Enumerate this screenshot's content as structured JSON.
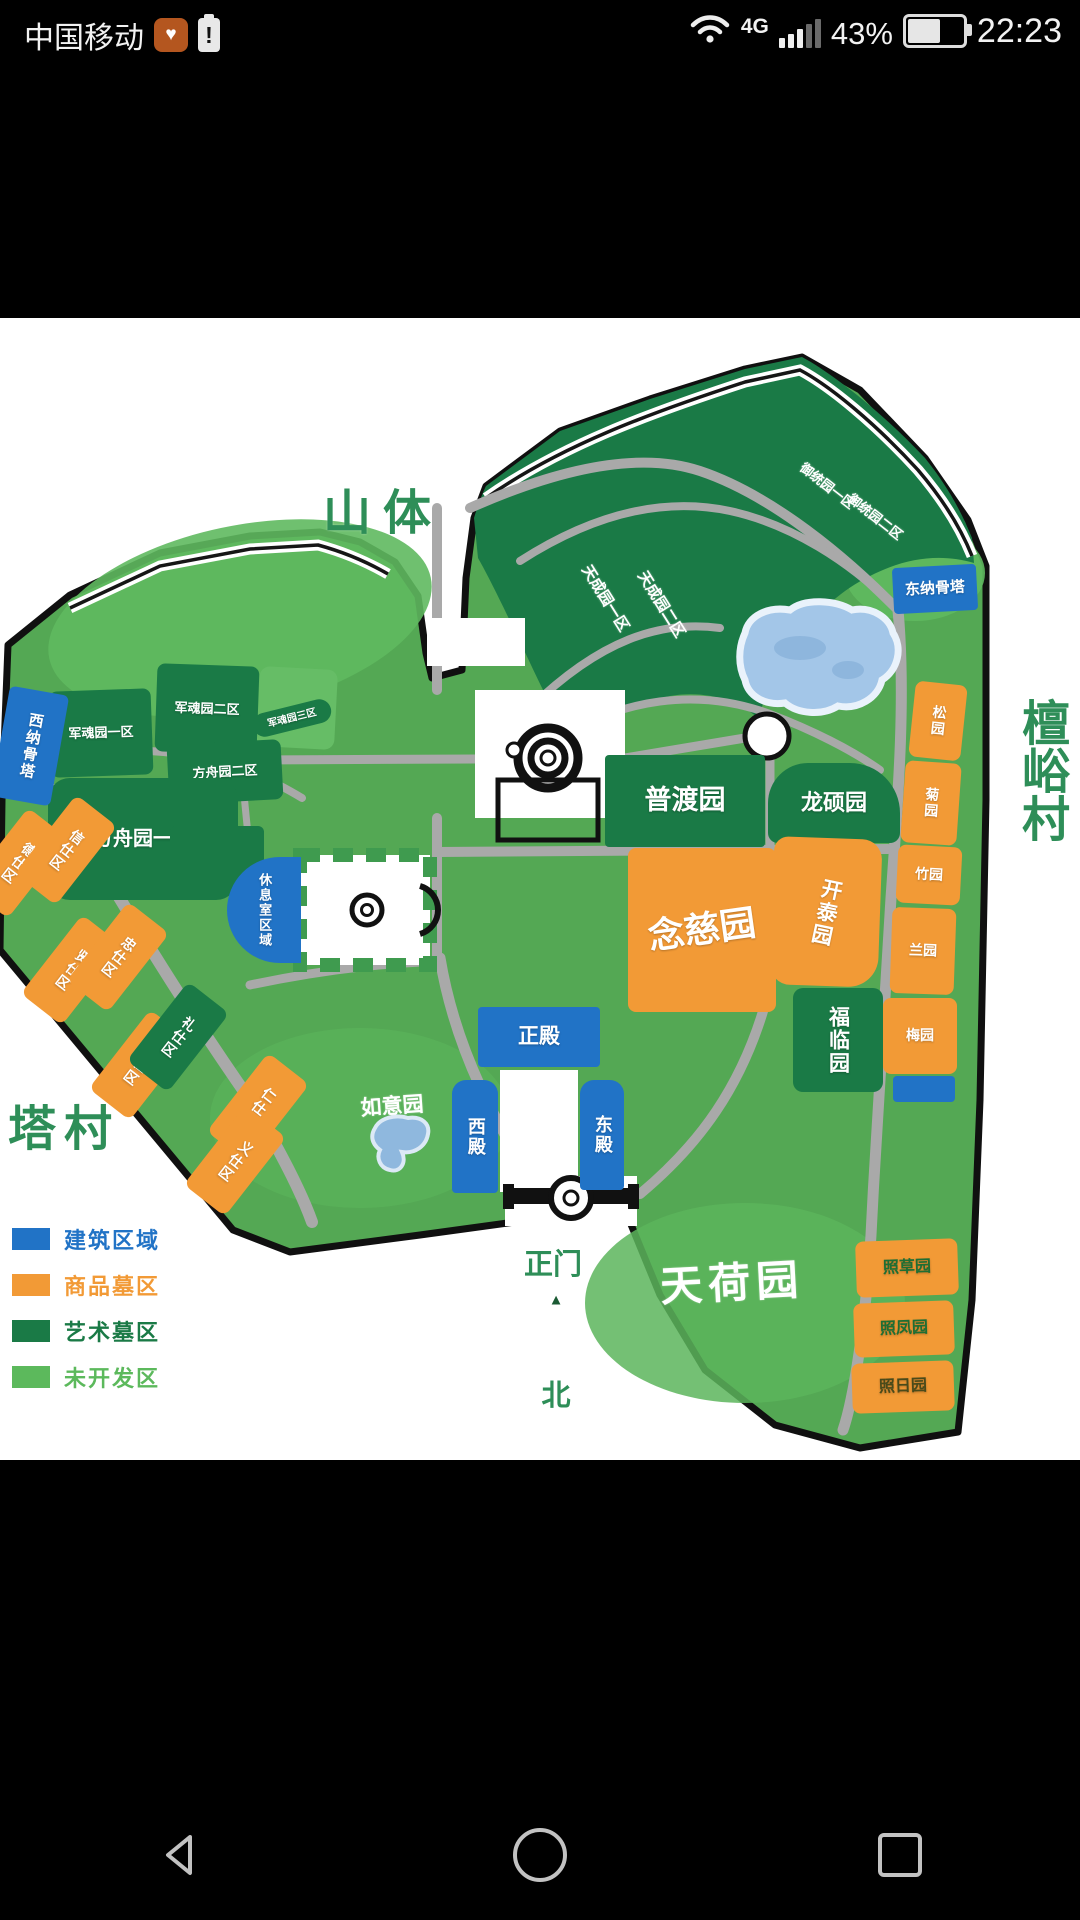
{
  "status_bar": {
    "carrier": "中国移动",
    "health_icon_char": "♥",
    "battery_alert_char": "!",
    "network_type": "4G",
    "battery_percent": "43%",
    "time": "22:23"
  },
  "map": {
    "regions": [
      {
        "id": "junhun3-bg",
        "label": "",
        "cls": "undev2",
        "x": 258,
        "y": 350,
        "w": 78,
        "h": 80,
        "rot": 3,
        "r": 10
      },
      {
        "id": "junhun2",
        "label": "军魂园二区",
        "cls": "art",
        "x": 156,
        "y": 347,
        "w": 102,
        "h": 88,
        "rot": 2,
        "fs": 13,
        "r": 8
      },
      {
        "id": "junhun1",
        "label": "军魂园一区",
        "cls": "art",
        "x": 50,
        "y": 372,
        "w": 102,
        "h": 86,
        "rot": -2,
        "fs": 13,
        "r": 8
      },
      {
        "id": "junhun3",
        "label": "军魂园三区",
        "cls": "art",
        "x": 252,
        "y": 388,
        "w": 80,
        "h": 24,
        "rot": -14,
        "fs": 10,
        "r": 14
      },
      {
        "id": "fangzhou2",
        "label": "方舟园二区",
        "cls": "art",
        "x": 168,
        "y": 424,
        "w": 114,
        "h": 60,
        "rot": -3,
        "fs": 13,
        "r": 8
      },
      {
        "id": "fangzhou1",
        "label": "方舟园一区",
        "cls": "art",
        "x": 48,
        "y": 460,
        "w": 190,
        "h": 122,
        "rot": 0,
        "fs": 20,
        "r": 22
      },
      {
        "id": "xiuxi-bg",
        "label": "",
        "cls": "art",
        "x": 170,
        "y": 508,
        "w": 94,
        "h": 62,
        "rot": 0,
        "r": 6
      },
      {
        "id": "pudu",
        "label": "普渡园",
        "cls": "art",
        "x": 605,
        "y": 437,
        "w": 160,
        "h": 92,
        "rot": 0,
        "fs": 27,
        "r": 4
      },
      {
        "id": "longshuo",
        "label": "龙硕园",
        "cls": "art",
        "x": 768,
        "y": 445,
        "w": 132,
        "h": 80,
        "rot": 0,
        "fs": 22,
        "r": "40px 50px 10px 10px"
      },
      {
        "id": "nianci",
        "label": "念慈园",
        "cls": "com",
        "x": 628,
        "y": 530,
        "w": 148,
        "h": 164,
        "rot": 0,
        "fs": 36,
        "r": 8,
        "lrot": -8
      },
      {
        "id": "kaitai",
        "label": "开泰园",
        "cls": "com",
        "x": 772,
        "y": 520,
        "w": 108,
        "h": 148,
        "rot": 2,
        "fs": 21,
        "vert": 1,
        "r": "14px 20px 30px 20px",
        "lrot": 10
      },
      {
        "id": "fulin",
        "label": "福临园",
        "cls": "art",
        "x": 793,
        "y": 670,
        "w": 90,
        "h": 104,
        "rot": 0,
        "fs": 21,
        "vert": 1,
        "r": 10
      },
      {
        "id": "shi-de",
        "label": "德仕区",
        "cls": "com",
        "x": -8,
        "y": 495,
        "w": 52,
        "h": 100,
        "rot": 38,
        "fs": 14,
        "vert": 1,
        "r": 8
      },
      {
        "id": "shi-xin",
        "label": "信仕区",
        "cls": "com",
        "x": 40,
        "y": 482,
        "w": 52,
        "h": 100,
        "rot": 38,
        "fs": 14,
        "vert": 1,
        "r": 8
      },
      {
        "id": "shi-xian",
        "label": "贤仕区",
        "cls": "com",
        "x": 46,
        "y": 602,
        "w": 52,
        "h": 100,
        "rot": 38,
        "fs": 14,
        "vert": 1,
        "r": 8
      },
      {
        "id": "shi-zhong",
        "label": "忠仕区",
        "cls": "com",
        "x": 92,
        "y": 589,
        "w": 52,
        "h": 100,
        "rot": 38,
        "fs": 14,
        "vert": 1,
        "r": 8
      },
      {
        "id": "shi-zhi",
        "label": "智仕区",
        "cls": "com",
        "x": 114,
        "y": 697,
        "w": 52,
        "h": 100,
        "rot": 38,
        "fs": 14,
        "vert": 1,
        "r": 8
      },
      {
        "id": "shi-li",
        "label": "礼仕区",
        "cls": "art",
        "x": 152,
        "y": 669,
        "w": 52,
        "h": 100,
        "rot": 38,
        "fs": 14,
        "vert": 1,
        "r": 8
      },
      {
        "id": "shi-ren",
        "label": "仁仕区",
        "cls": "com",
        "x": 232,
        "y": 740,
        "w": 52,
        "h": 100,
        "rot": 38,
        "fs": 14,
        "vert": 1,
        "r": 8
      },
      {
        "id": "shi-yi",
        "label": "义仕区",
        "cls": "com",
        "x": 209,
        "y": 793,
        "w": 52,
        "h": 100,
        "rot": 38,
        "fs": 14,
        "vert": 1,
        "r": 8
      },
      {
        "id": "song",
        "label": "松园",
        "cls": "com",
        "x": 912,
        "y": 365,
        "w": 52,
        "h": 76,
        "rot": 6,
        "fs": 14,
        "vert": 1,
        "r": 8
      },
      {
        "id": "ju",
        "label": "菊园",
        "cls": "com",
        "x": 903,
        "y": 444,
        "w": 56,
        "h": 82,
        "rot": 4,
        "fs": 14,
        "vert": 1,
        "r": 8
      },
      {
        "id": "zhu",
        "label": "竹园",
        "cls": "com",
        "x": 897,
        "y": 528,
        "w": 64,
        "h": 58,
        "rot": 3,
        "fs": 14,
        "r": 8
      },
      {
        "id": "lan",
        "label": "兰园",
        "cls": "com",
        "x": 891,
        "y": 590,
        "w": 64,
        "h": 86,
        "rot": 2,
        "fs": 14,
        "r": 8
      },
      {
        "id": "mei",
        "label": "梅园",
        "cls": "com",
        "x": 883,
        "y": 680,
        "w": 74,
        "h": 76,
        "rot": 0,
        "fs": 14,
        "r": 8
      },
      {
        "id": "blue-annex",
        "label": "",
        "cls": "bld",
        "x": 893,
        "y": 758,
        "w": 62,
        "h": 26,
        "rot": 0,
        "r": 4
      },
      {
        "id": "zhaocao",
        "label": "照草园",
        "cls": "com",
        "x": 856,
        "y": 922,
        "w": 102,
        "h": 56,
        "rot": -2,
        "fs": 16,
        "r": 8,
        "tc": "#1f6e33"
      },
      {
        "id": "zhaofeng",
        "label": "照凤园",
        "cls": "com",
        "x": 854,
        "y": 984,
        "w": 100,
        "h": 54,
        "rot": -2,
        "fs": 16,
        "r": 8,
        "tc": "#1f6e33"
      },
      {
        "id": "zhaori",
        "label": "照日园",
        "cls": "com",
        "x": 852,
        "y": 1044,
        "w": 102,
        "h": 50,
        "rot": -2,
        "fs": 16,
        "r": 8,
        "tc": "#4a4a1a"
      },
      {
        "id": "xina",
        "label": "西纳骨塔",
        "cls": "bld",
        "x": 0,
        "y": 372,
        "w": 60,
        "h": 112,
        "rot": 10,
        "fs": 15,
        "vert": 1,
        "r": 6
      },
      {
        "id": "dongna",
        "label": "东纳骨塔",
        "cls": "bld",
        "x": 893,
        "y": 248,
        "w": 84,
        "h": 46,
        "rot": -3,
        "fs": 15,
        "r": 4
      },
      {
        "id": "zhengdian",
        "label": "正殿",
        "cls": "bld",
        "x": 478,
        "y": 689,
        "w": 122,
        "h": 60,
        "rot": 0,
        "fs": 21,
        "r": 4
      },
      {
        "id": "xidian",
        "label": "西殿",
        "cls": "bld",
        "x": 452,
        "y": 762,
        "w": 46,
        "h": 113,
        "rot": 0,
        "fs": 18,
        "vert": 1,
        "r": "14px 14px 4px 4px"
      },
      {
        "id": "dongdian",
        "label": "东殿",
        "cls": "bld",
        "x": 580,
        "y": 762,
        "w": 44,
        "h": 110,
        "rot": 0,
        "fs": 18,
        "vert": 1,
        "r": "14px 14px 4px 4px"
      },
      {
        "id": "xiuxi",
        "label": "休息室区域",
        "cls": "bld",
        "x": 227,
        "y": 539,
        "w": 74,
        "h": 106,
        "rot": 0,
        "fs": 13,
        "vert": 1,
        "r": "60px 0 0 60px"
      }
    ],
    "floats": [
      {
        "id": "shanti",
        "text": "山体",
        "cx": 383,
        "cy": 190,
        "fs": 48,
        "color": "#2e8e58",
        "ls": 12
      },
      {
        "id": "tanyucun",
        "text": "檀峪村",
        "cx": 1040,
        "cy": 452,
        "fs": 48,
        "color": "#2e8e58",
        "vert": 1
      },
      {
        "id": "tacun",
        "text": "塔村",
        "cx": 64,
        "cy": 806,
        "fs": 48,
        "color": "#2e8e58",
        "ls": 8
      },
      {
        "id": "tiancheng1",
        "text": "天成园一区",
        "cx": 606,
        "cy": 280,
        "fs": 15,
        "color": "#fff",
        "rot": 58
      },
      {
        "id": "tiancheng2",
        "text": "天成园二区",
        "cx": 662,
        "cy": 286,
        "fs": 15,
        "color": "#fff",
        "rot": 58
      },
      {
        "id": "yutong1",
        "text": "御统园一区",
        "cx": 828,
        "cy": 167,
        "fs": 13,
        "color": "#fff",
        "rot": 38
      },
      {
        "id": "yutong2",
        "text": "御统园二区",
        "cx": 876,
        "cy": 198,
        "fs": 13,
        "color": "#fff",
        "rot": 38
      },
      {
        "id": "ruyi",
        "text": "如意园",
        "cx": 392,
        "cy": 787,
        "fs": 21,
        "color": "#fff",
        "rot": -4
      },
      {
        "id": "tianhe",
        "text": "天荷园",
        "cx": 732,
        "cy": 962,
        "fs": 42,
        "color": "#fff",
        "rot": -3,
        "ls": 6
      },
      {
        "id": "zhengmen",
        "text": "正门",
        "cx": 553,
        "cy": 944,
        "fs": 29,
        "color": "#2e8e58"
      },
      {
        "id": "north-marker",
        "text": "▲",
        "cx": 556,
        "cy": 982,
        "fs": 15,
        "color": "#1a5a33"
      },
      {
        "id": "bei",
        "text": "北",
        "cx": 556,
        "cy": 1075,
        "fs": 29,
        "color": "#2e8e58"
      }
    ],
    "legend": {
      "items": [
        {
          "label": "建筑区域",
          "color": "#2173c6"
        },
        {
          "label": "商品墓区",
          "color": "#f29a36"
        },
        {
          "label": "艺术墓区",
          "color": "#1a7a46"
        },
        {
          "label": "未开发区",
          "color": "#5cb95c"
        }
      ]
    }
  },
  "nav_bar": {
    "icons": [
      "back",
      "home",
      "recents"
    ]
  }
}
